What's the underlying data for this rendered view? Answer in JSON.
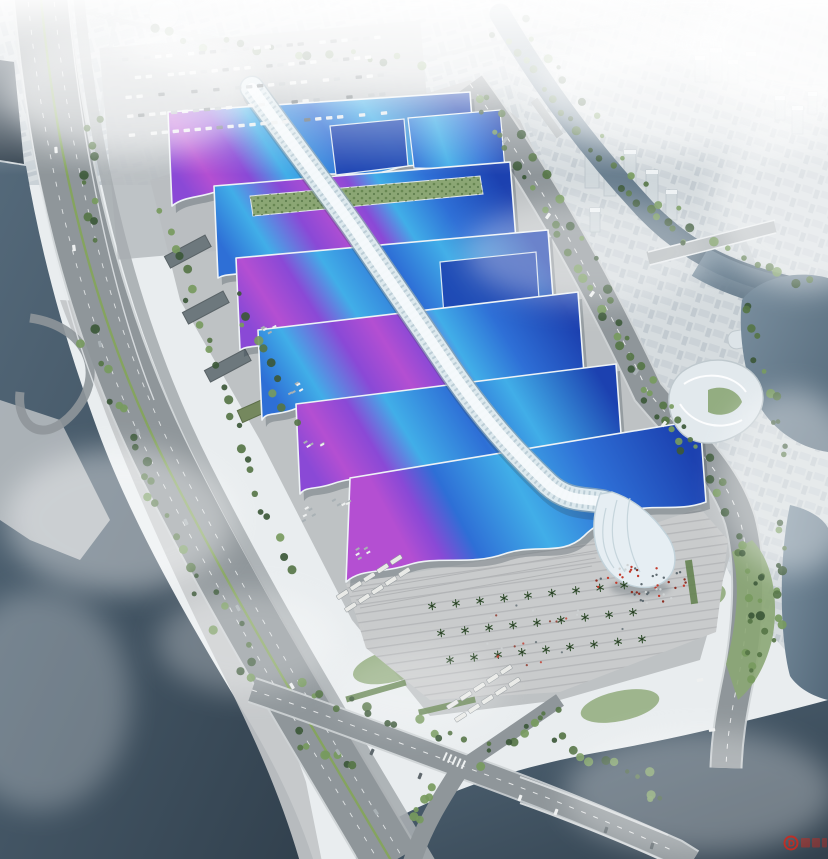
{
  "scene": {
    "subject": "aerial rendering of riverside exhibition and convention center complex",
    "hall_rows": 6,
    "watermark": {
      "logo_letter": "D"
    }
  },
  "palette": {
    "fog": "#e9edef",
    "city_base": "#d6dcdf",
    "city_block": "#c8d0d5",
    "city_block2": "#bdc6cc",
    "tower": "#cfd7db",
    "dome": "#d9dfe2",
    "water_light": "#7b90a0",
    "water_mid": "#54697a",
    "water_dark": "#31404d",
    "quay": "#c2c6c8",
    "road": "#8f969a",
    "road_light": "#a7adb0",
    "road_edge": "#ced3d5",
    "lane": "#f4f6f6",
    "median": "#85a45e",
    "tree_dark": "#3c5838",
    "tree_mid": "#567546",
    "tree_light": "#779a5e",
    "lawn": "#8ba674",
    "hedge": "#5f7f4a",
    "plaza": "#c9cbcc",
    "plaza_line": "#b3b5b7",
    "apron": "#bec2c4",
    "warehouse": "#6d787d",
    "shed_green": "#75885e",
    "roof_deep": "#1c41b0",
    "roof_blue": "#2e6fd6",
    "roof_sky": "#41aee8",
    "ribbon_purple": "#8a49d6",
    "ribbon_magenta": "#b44fd2",
    "eave": "#eef3f6",
    "hall_shadow": "#2c3a44",
    "spine_light": "#f5fafc",
    "spine_mid": "#dde9ee",
    "spine_shade": "#93abb8",
    "shell": "#e6eef3",
    "rib": "#c6d5dc",
    "people_red": "#c23a2c",
    "people_dark": "#5e6a70",
    "bus": "#e9eae7",
    "car_dark": "#5f686d",
    "car_mid": "#a9b1b5",
    "car_light": "#eef0f0",
    "watermark": "#d0281c"
  }
}
